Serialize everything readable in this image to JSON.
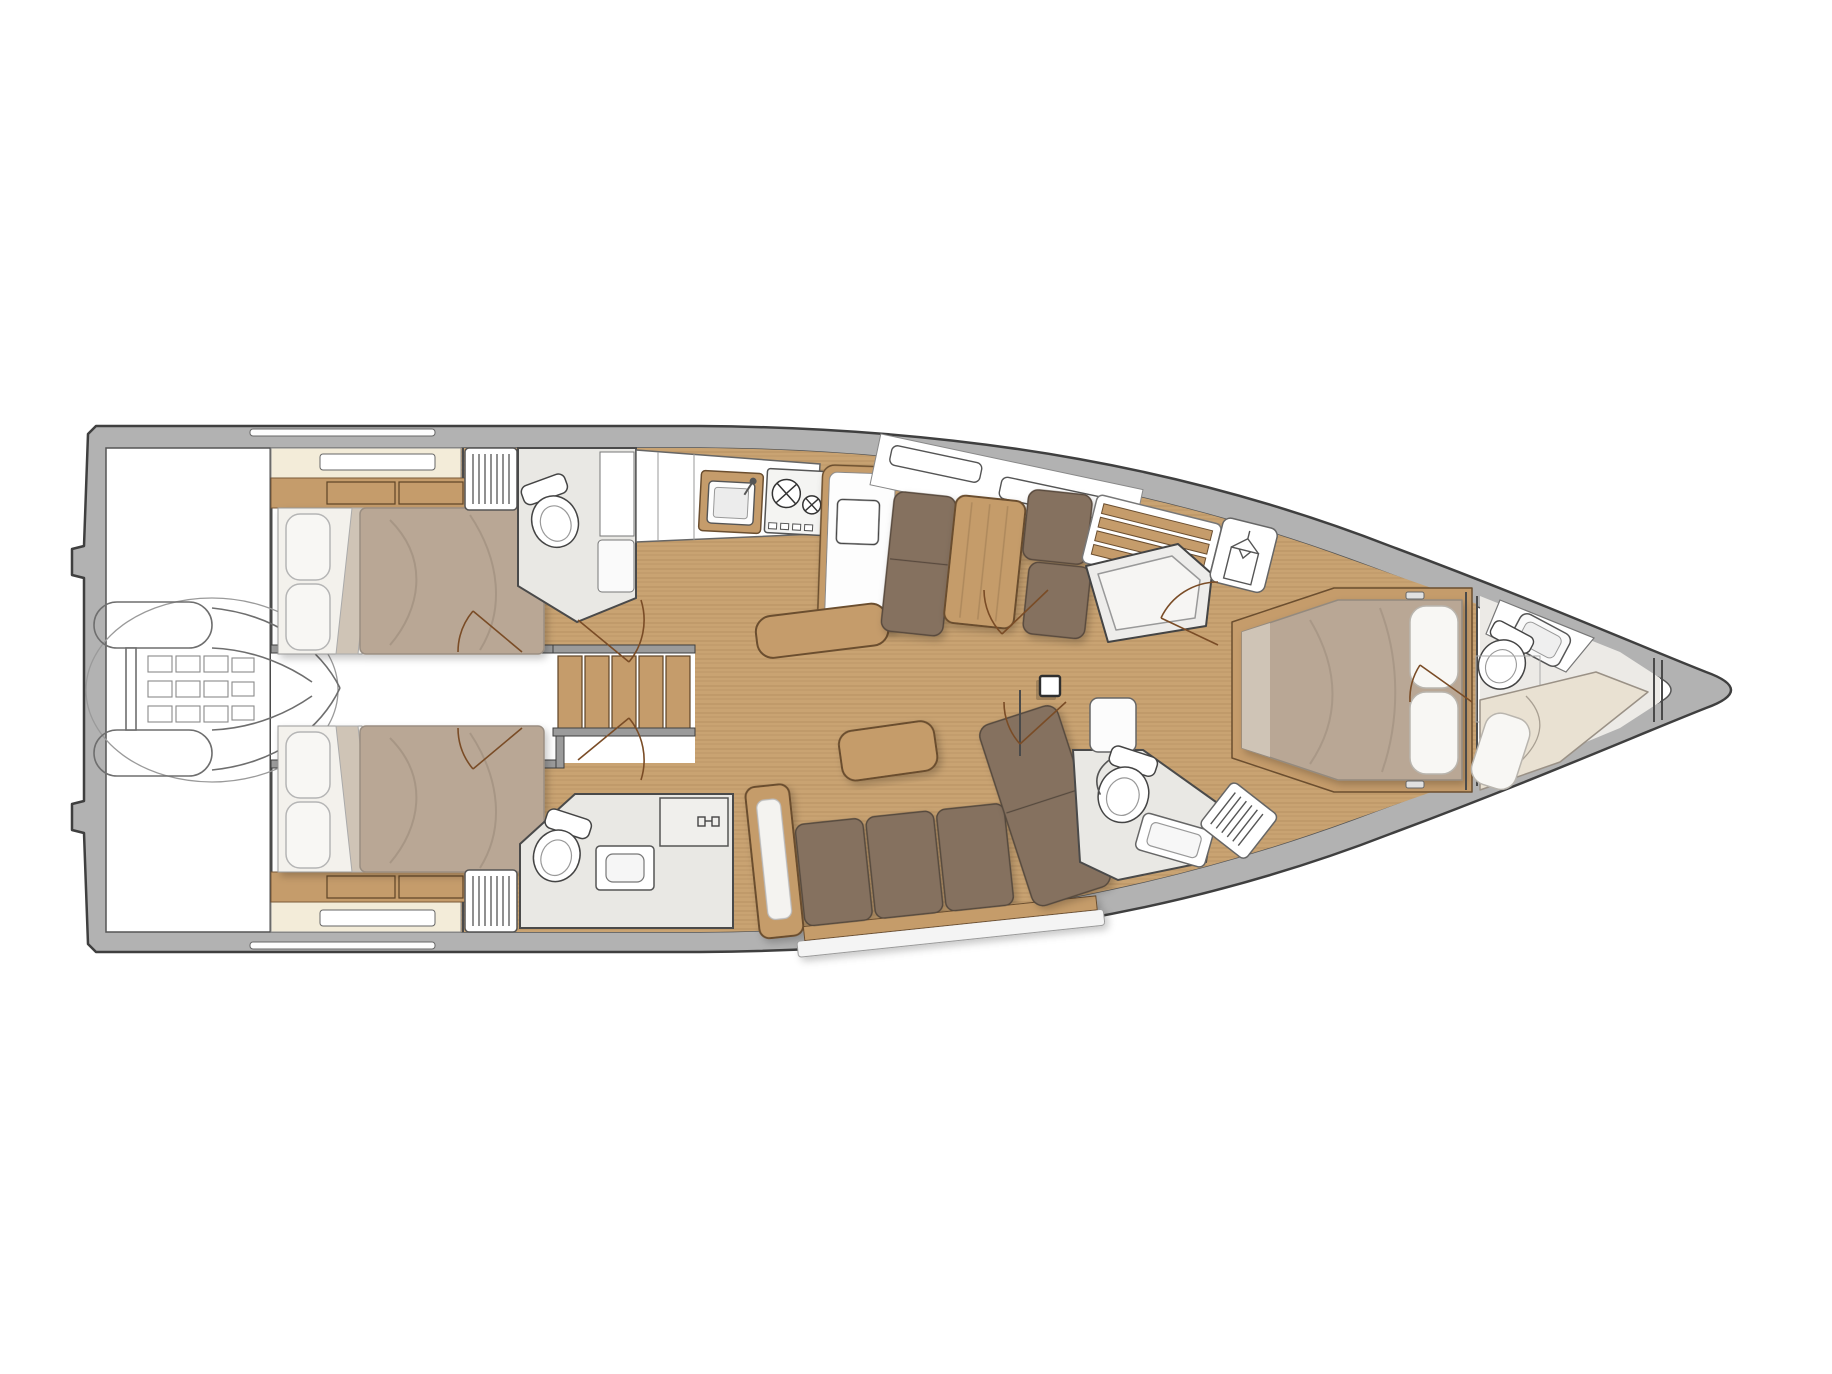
{
  "canvas": {
    "width": 1832,
    "height": 1374,
    "background": "#ffffff"
  },
  "colors": {
    "hull_band": "#b2b2b2",
    "hull_outline": "#3f3f3f",
    "inner_line": "#555555",
    "wood_floor": "#c9a372",
    "wood_furniture": "#c59c6b",
    "wood_dark": "#6b4e2f",
    "mattress": "#b9a795",
    "mattress_fold": "#cfc4b6",
    "pillow": "#f8f7f4",
    "cream_shelf": "#f3ecd9",
    "sofa_brown": "#85715f",
    "sofa_dark": "#55483d",
    "head_floor": "#e9e8e4",
    "white": "#ffffff",
    "wall_gray": "#9b9b9b",
    "door_arc": "#7a4c26",
    "dinghy_line": "#8c8c8c",
    "berth_cream": "#e9e1d2",
    "shower_floor": "#edecea"
  },
  "vessel": {
    "type": "sailing-yacht-interior-deck-plan",
    "view": "top-down",
    "bow_direction": "right",
    "areas": {
      "stern_garage": {
        "items": [
          "tender-dinghy",
          "stowage-ellipse",
          "transom-notches"
        ]
      },
      "port_aft_cabin": {
        "items": [
          "double-bed",
          "two-pillows",
          "duvet",
          "head-shelf",
          "drawers",
          "louvered-locker"
        ]
      },
      "starboard_aft_cabin": {
        "items": [
          "double-bed",
          "two-pillows",
          "duvet",
          "head-shelf",
          "drawers",
          "louvered-locker"
        ]
      },
      "port_aft_head": {
        "items": [
          "toilet",
          "tall-cabinet",
          "seat-shelf"
        ]
      },
      "starboard_day_head": {
        "items": [
          "toilet",
          "sink",
          "shower-locker-with-handles"
        ]
      },
      "companionway": {
        "items": [
          "five-tread-stairs",
          "handrails",
          "garage-corridor"
        ]
      },
      "galley": {
        "items": [
          "cabinet-bank",
          "sink-with-faucet",
          "two-burner-stove",
          "island-counter-with-sink",
          "curved-wood-bench"
        ]
      },
      "dinette": {
        "items": [
          "port-bench-seat",
          "wood-table",
          "forward-bench-seat",
          "hull-shelf-with-cubbies"
        ]
      },
      "salon": {
        "items": [
          "l-shaped-sofa",
          "chaise-cushion",
          "coffee-table",
          "wood-armrest",
          "mast-post"
        ]
      },
      "mid_starboard_zone": {
        "items": [
          "slatted-seat",
          "shower-stall",
          "hanging-locker"
        ]
      },
      "starboard_mid_head": {
        "items": [
          "toilet",
          "vanity",
          "louvered-unit",
          "door-panel"
        ]
      },
      "owner_cabin": {
        "items": [
          "island-double-bed",
          "two-pillows",
          "wood-bed-frame",
          "headboard-bulkhead",
          "frame-handles"
        ]
      },
      "forepeak": {
        "items": [
          "toilet",
          "diagonal-sink-counter",
          "crew-berth",
          "berth-pillow",
          "collision-bulkhead"
        ]
      }
    }
  }
}
